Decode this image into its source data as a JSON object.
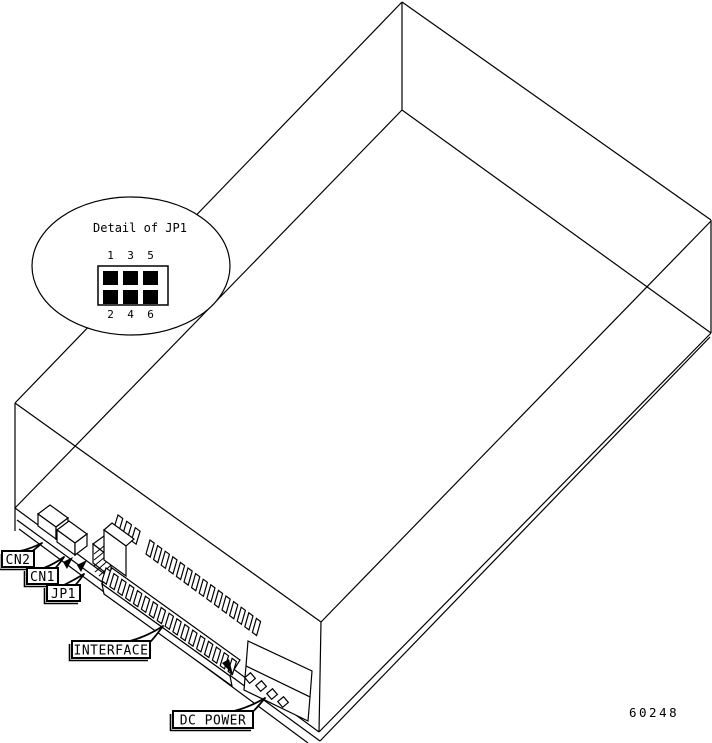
{
  "colors": {
    "line": "#000000",
    "background": "#ffffff"
  },
  "detail_callout": {
    "title": "Detail of JP1",
    "top_pin_labels": [
      "1",
      "3",
      "5"
    ],
    "bottom_pin_labels": [
      "2",
      "4",
      "6"
    ]
  },
  "component_labels": {
    "cn2": "CN2",
    "cn1": "CN1",
    "jp1": "JP1",
    "interface": "INTERFACE",
    "dc_power": "DC POWER"
  },
  "figure_number": "60248"
}
